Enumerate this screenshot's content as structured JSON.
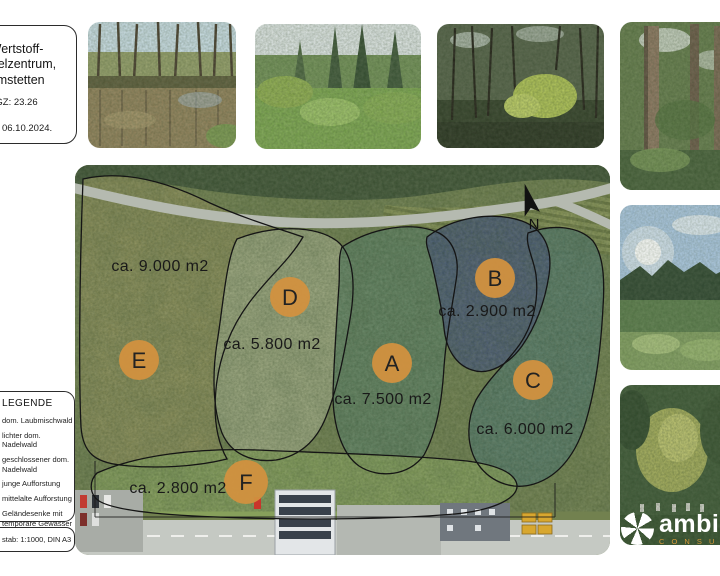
{
  "page": {
    "background": "#ffffff"
  },
  "info_box": {
    "title_line1": "Wertstoff-",
    "title_line2": "mmelzentrum,",
    "title_line3": "Amstetten",
    "gz": "GZ: 23.26",
    "date": "tum: 06.10.2024."
  },
  "map": {
    "north_label": "N",
    "marker_color": "#d2913f",
    "zones": [
      {
        "letter": "A",
        "area": "ca. 7.500 m2"
      },
      {
        "letter": "B",
        "area": "ca. 2.900 m2"
      },
      {
        "letter": "C",
        "area": "ca. 6.000 m2"
      },
      {
        "letter": "D",
        "area": "ca. 5.800 m2"
      },
      {
        "letter": "E",
        "area": "ca. 9.000 m2"
      },
      {
        "letter": "F",
        "area": "ca. 2.800 m2"
      }
    ]
  },
  "legend": {
    "title": "LEGENDE",
    "items": [
      {
        "label": "dom. Laubmischwald"
      },
      {
        "label": "lichter dom. Nadelwald"
      },
      {
        "label": "geschlossener dom. Nadelwald"
      },
      {
        "label": "junge Aufforstung"
      },
      {
        "label": "mittelalte Aufforstung"
      },
      {
        "label": "Geländesenke mit temporäre Gewässer"
      }
    ]
  },
  "scale_box": {
    "text": "stab: 1:1000, DIN A3"
  },
  "logo": {
    "name": "ambie",
    "subtitle": "C O N S U"
  }
}
